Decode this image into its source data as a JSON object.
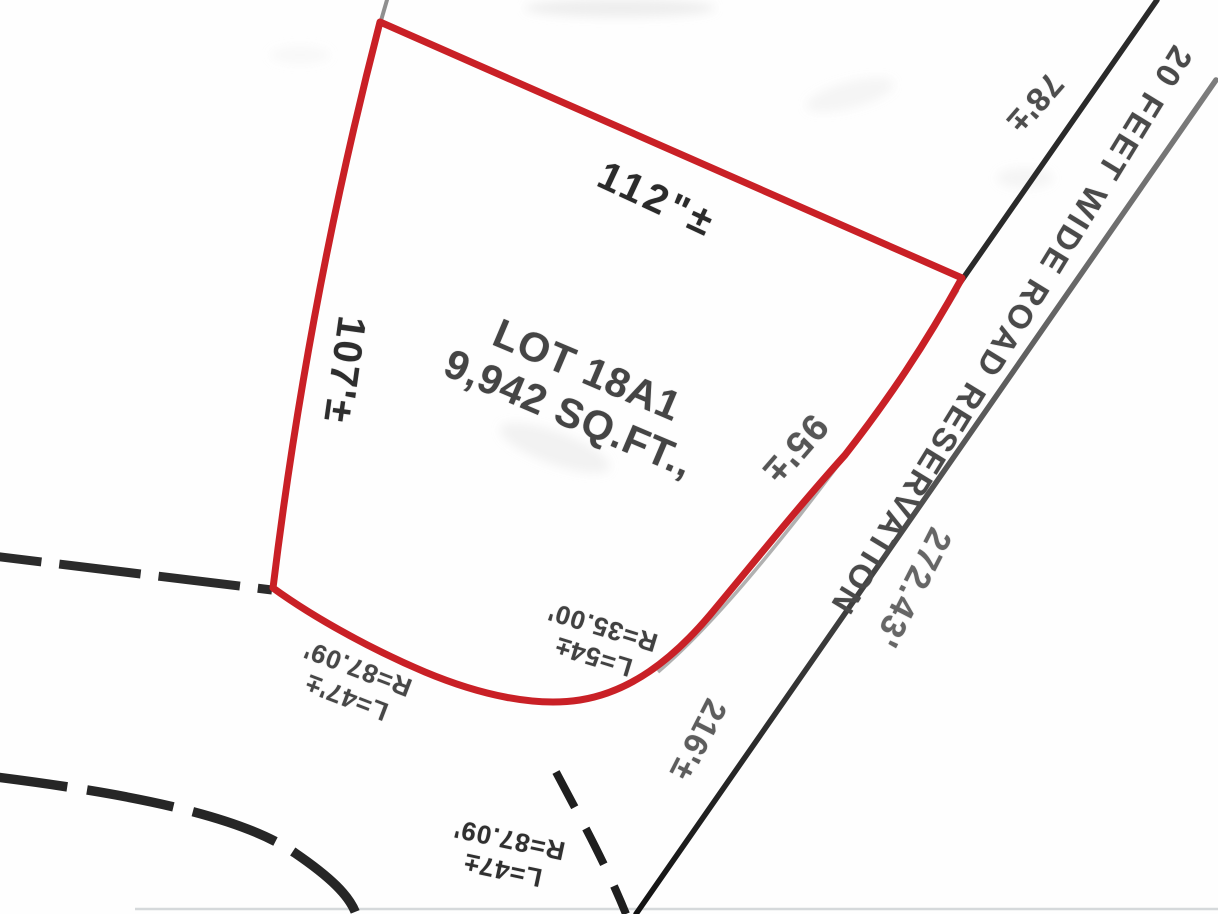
{
  "map": {
    "lot": {
      "name": "LOT 18A1",
      "area": "9,942 SQ.FT.,"
    },
    "dimensions": {
      "top_edge": "112\"±",
      "left_edge": "107'±",
      "right_edge": "95'±",
      "road_segment_upper": "78'±",
      "road_frontage": "216'±",
      "road_far_edge": "272.43'"
    },
    "road": {
      "name": "20 FEET WIDE ROAD RESERVATION"
    },
    "curves": {
      "corner": {
        "length": "L=54±",
        "radius": "R=35.00'"
      },
      "upper_left": {
        "length": "L=47'±",
        "radius": "R=87.09'"
      },
      "lower": {
        "length": "L=47±",
        "radius": "R=87.09'"
      }
    },
    "colors": {
      "lot_boundary_red": "#c92026",
      "road_line_black": "#2a2a2a",
      "dimension_text_gray": "#555555",
      "primary_text": "#333333"
    }
  }
}
